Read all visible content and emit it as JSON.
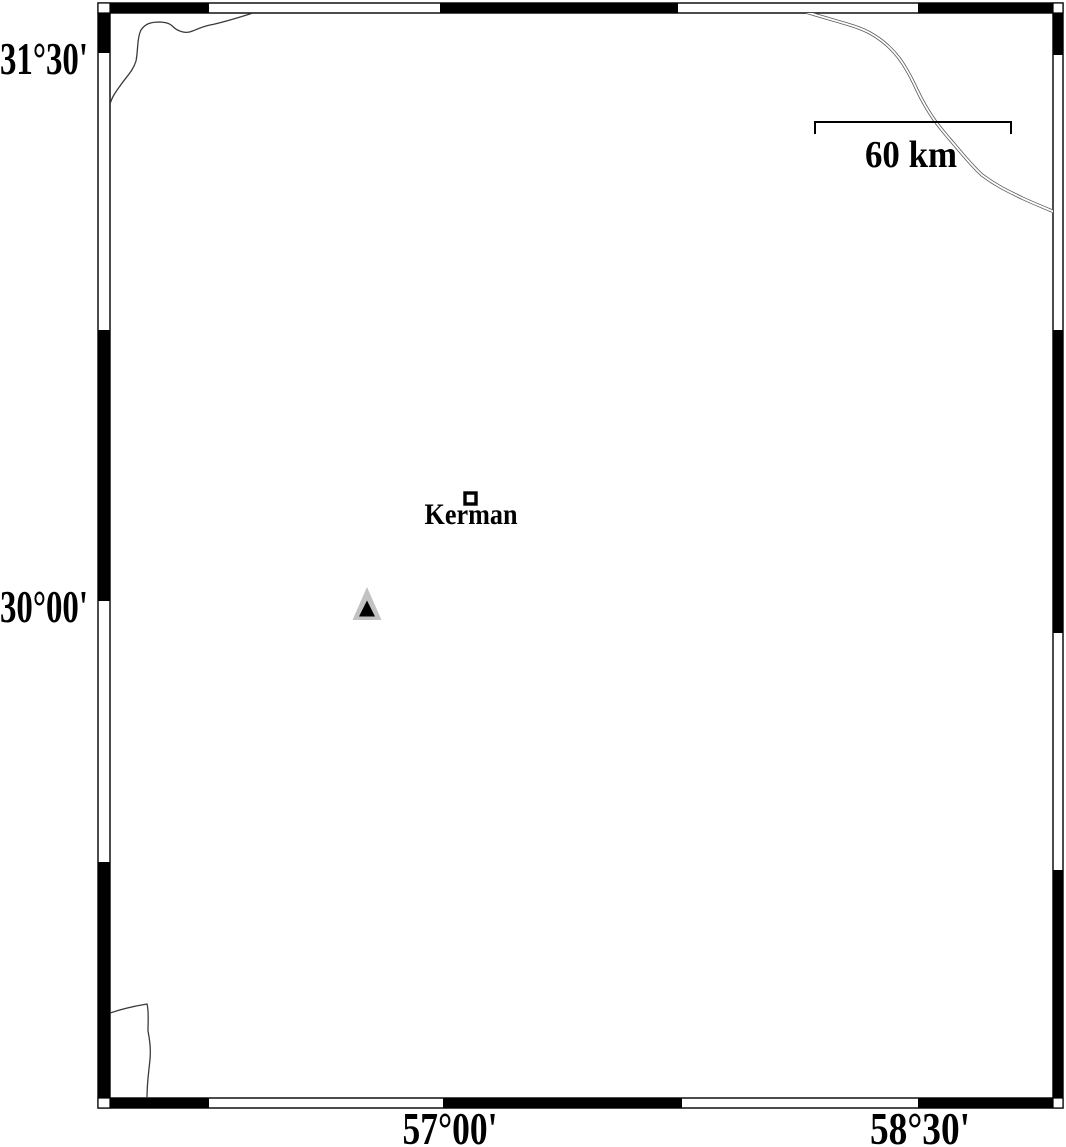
{
  "map": {
    "type": "geographic-map",
    "axis_labels": {
      "lat_top": "31°30'",
      "lat_mid": "30°00'",
      "lon_left": "57°00'",
      "lon_right": "58°30'"
    },
    "scale_bar": {
      "label": "60 km"
    },
    "city": {
      "name": "Kerman",
      "marker": "open-square"
    },
    "station": {
      "marker": "filled-triangle",
      "outer_fill": "#c2c2c2",
      "inner_fill": "#000000"
    },
    "colors": {
      "frame": "#000000",
      "background": "#ffffff",
      "river": "#3a3a3a",
      "road": "#5a5a5a"
    }
  }
}
